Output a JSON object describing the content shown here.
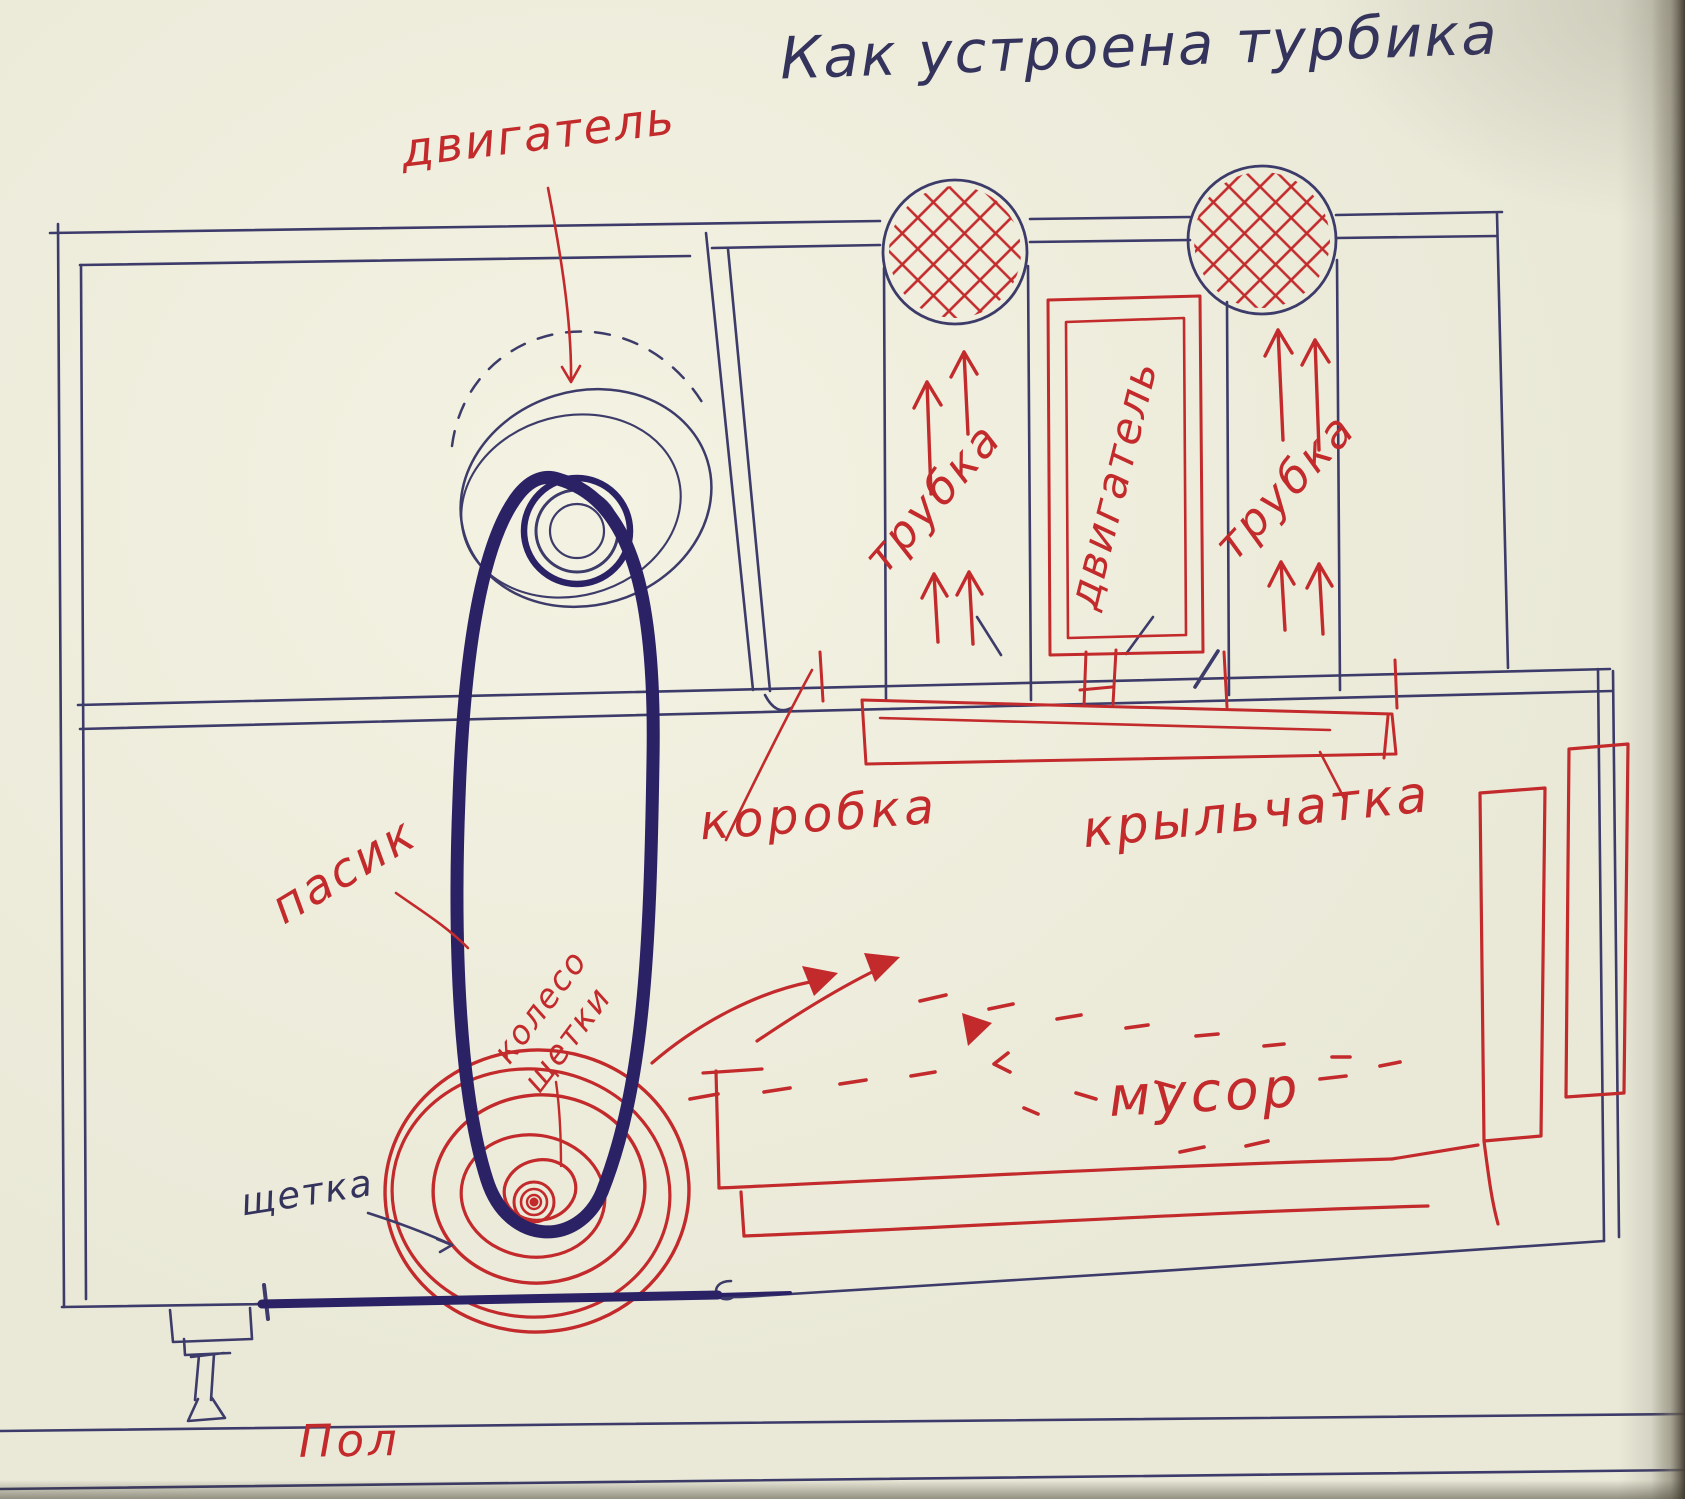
{
  "title": "Как устроена турбика",
  "labels": {
    "motor_callout": "двигатель",
    "tube_left": "трубка",
    "motor_box": "двигатель",
    "tube_right": "трубка",
    "gearbox": "коробка",
    "impeller": "крыльчатка",
    "belt": "пасик",
    "brush_wheel_line1": "колесо",
    "brush_wheel_line2": "щетки",
    "brush": "щетка",
    "debris": "мусор",
    "floor": "Пол"
  },
  "colors": {
    "paper": "#eae9d8",
    "paper_light": "#f3f1e1",
    "red_ink": "#c32a2c",
    "blue_ink": "#3c3b69",
    "belt_ink": "#2b2165",
    "title_ink": "#34335c",
    "edge_shadow": "#4e4a3d"
  }
}
